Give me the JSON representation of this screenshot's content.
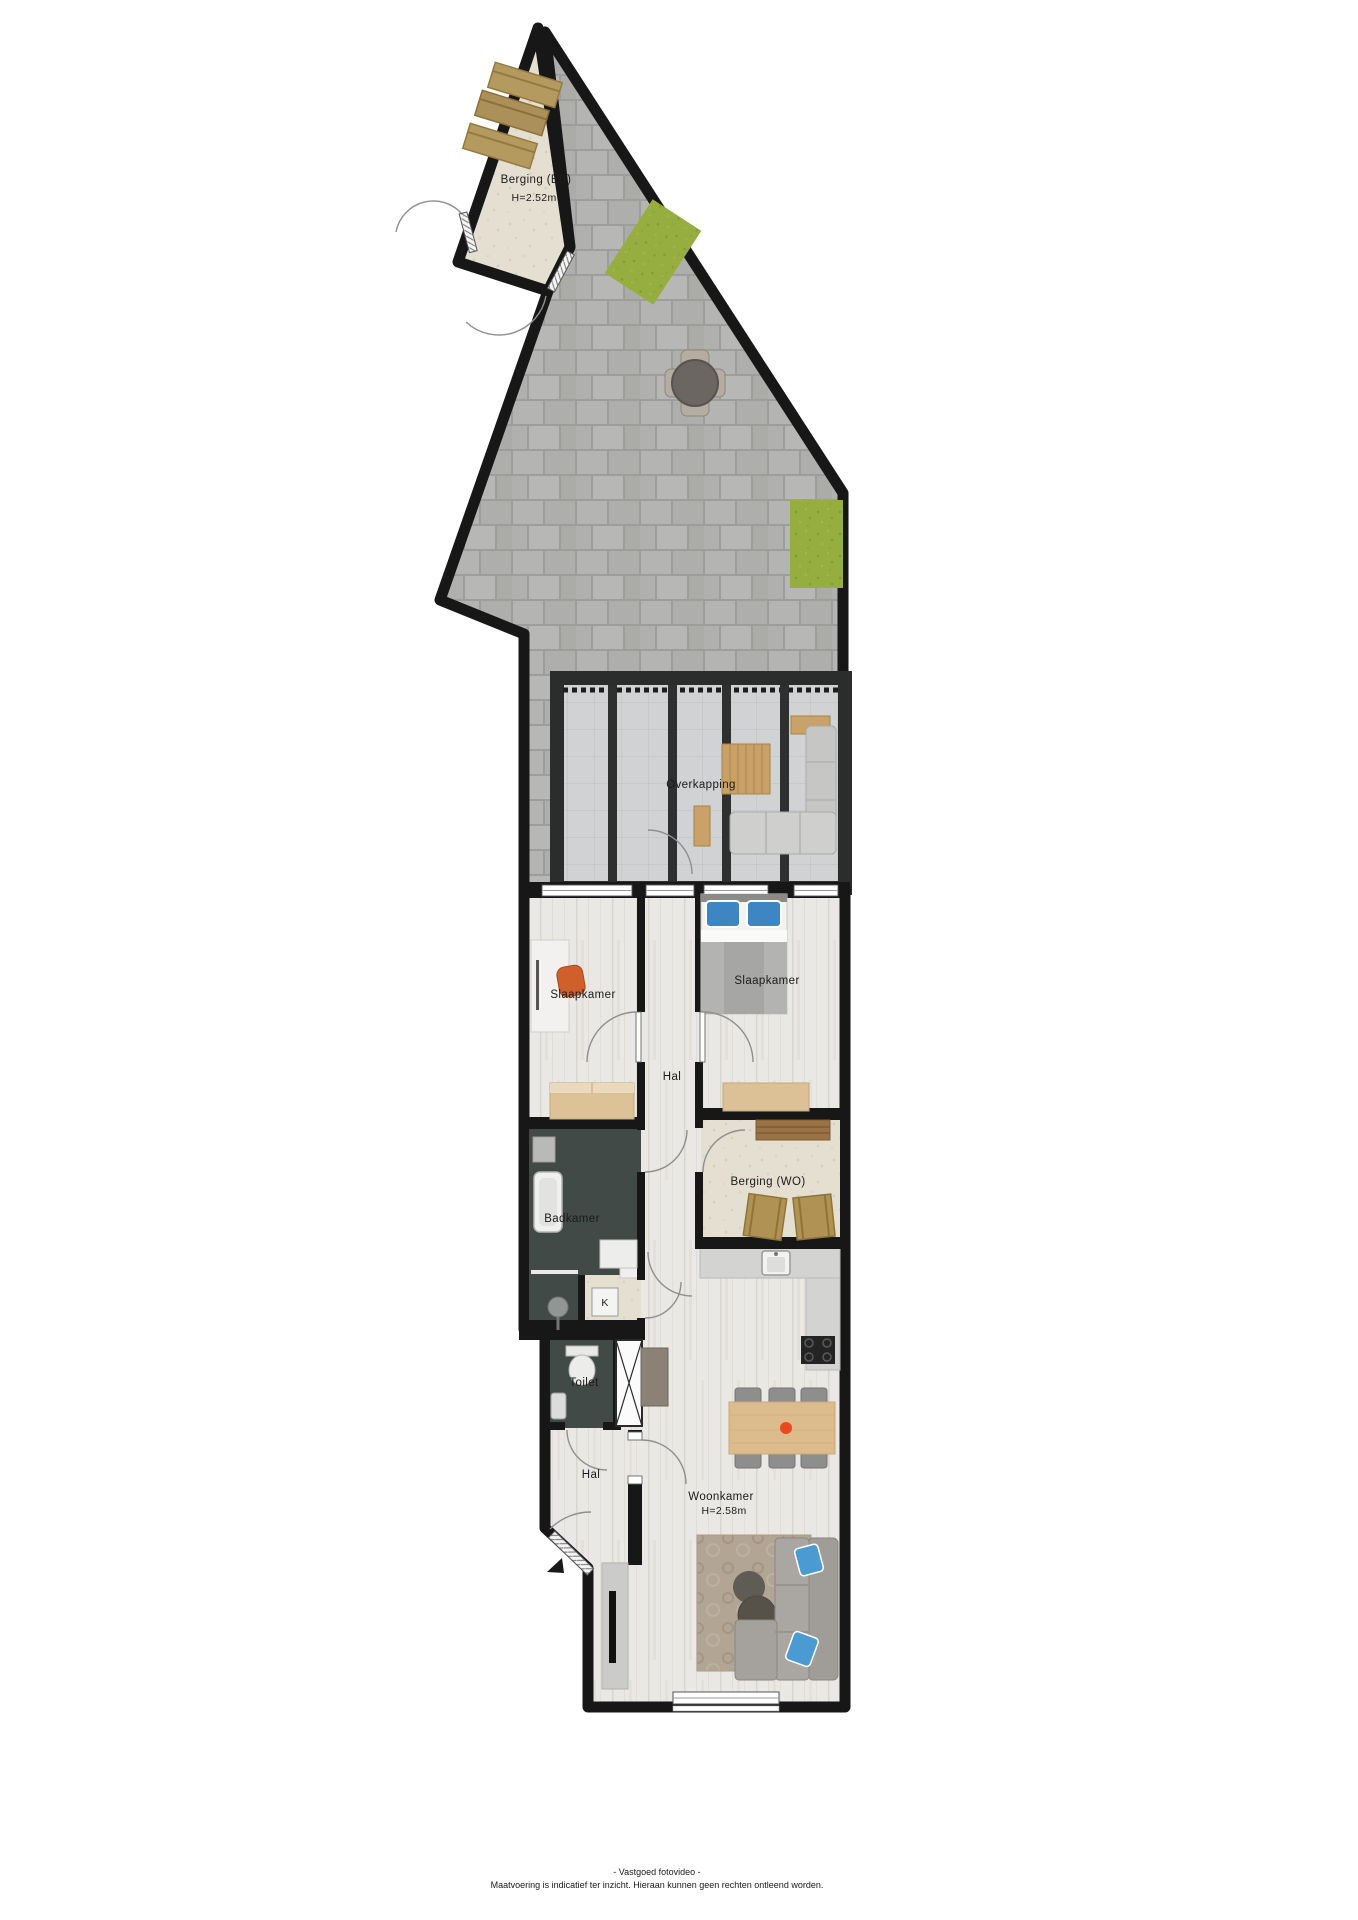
{
  "plan": {
    "rooms": {
      "berging_eb": {
        "label": "Berging (EB)",
        "height": "H=2.52m"
      },
      "overkapping": {
        "label": "Overkapping"
      },
      "slaapkamer_left": {
        "label": "Slaapkamer"
      },
      "slaapkamer_right": {
        "label": "Slaapkamer"
      },
      "hal_boven": {
        "label": "Hal"
      },
      "berging_wo": {
        "label": "Berging (WO)"
      },
      "badkamer": {
        "label": "Badkamer"
      },
      "kast": {
        "label": "K"
      },
      "toilet": {
        "label": "Toilet"
      },
      "hal_beneden": {
        "label": "Hal"
      },
      "woonkamer": {
        "label": "Woonkamer",
        "height": "H=2.58m"
      }
    },
    "colors": {
      "wall": "#171717",
      "paving": "#b4b5b2",
      "grass": "#95ae3f",
      "wood_floor": "#eae8e4",
      "bathroom_floor": "#414a46",
      "storage_floor": "#e4dfd1",
      "overkapping_floor": "#d1d2d4",
      "accent_chair": "#cf5f2b",
      "pillow_blue": "#3e86c2",
      "fruit_bowl": "#e8491d"
    }
  },
  "footer": {
    "line1": "- Vastgoed fotovideo -",
    "line2": "Maatvoering is indicatief ter inzicht. Hieraan kunnen geen rechten ontleend worden."
  }
}
